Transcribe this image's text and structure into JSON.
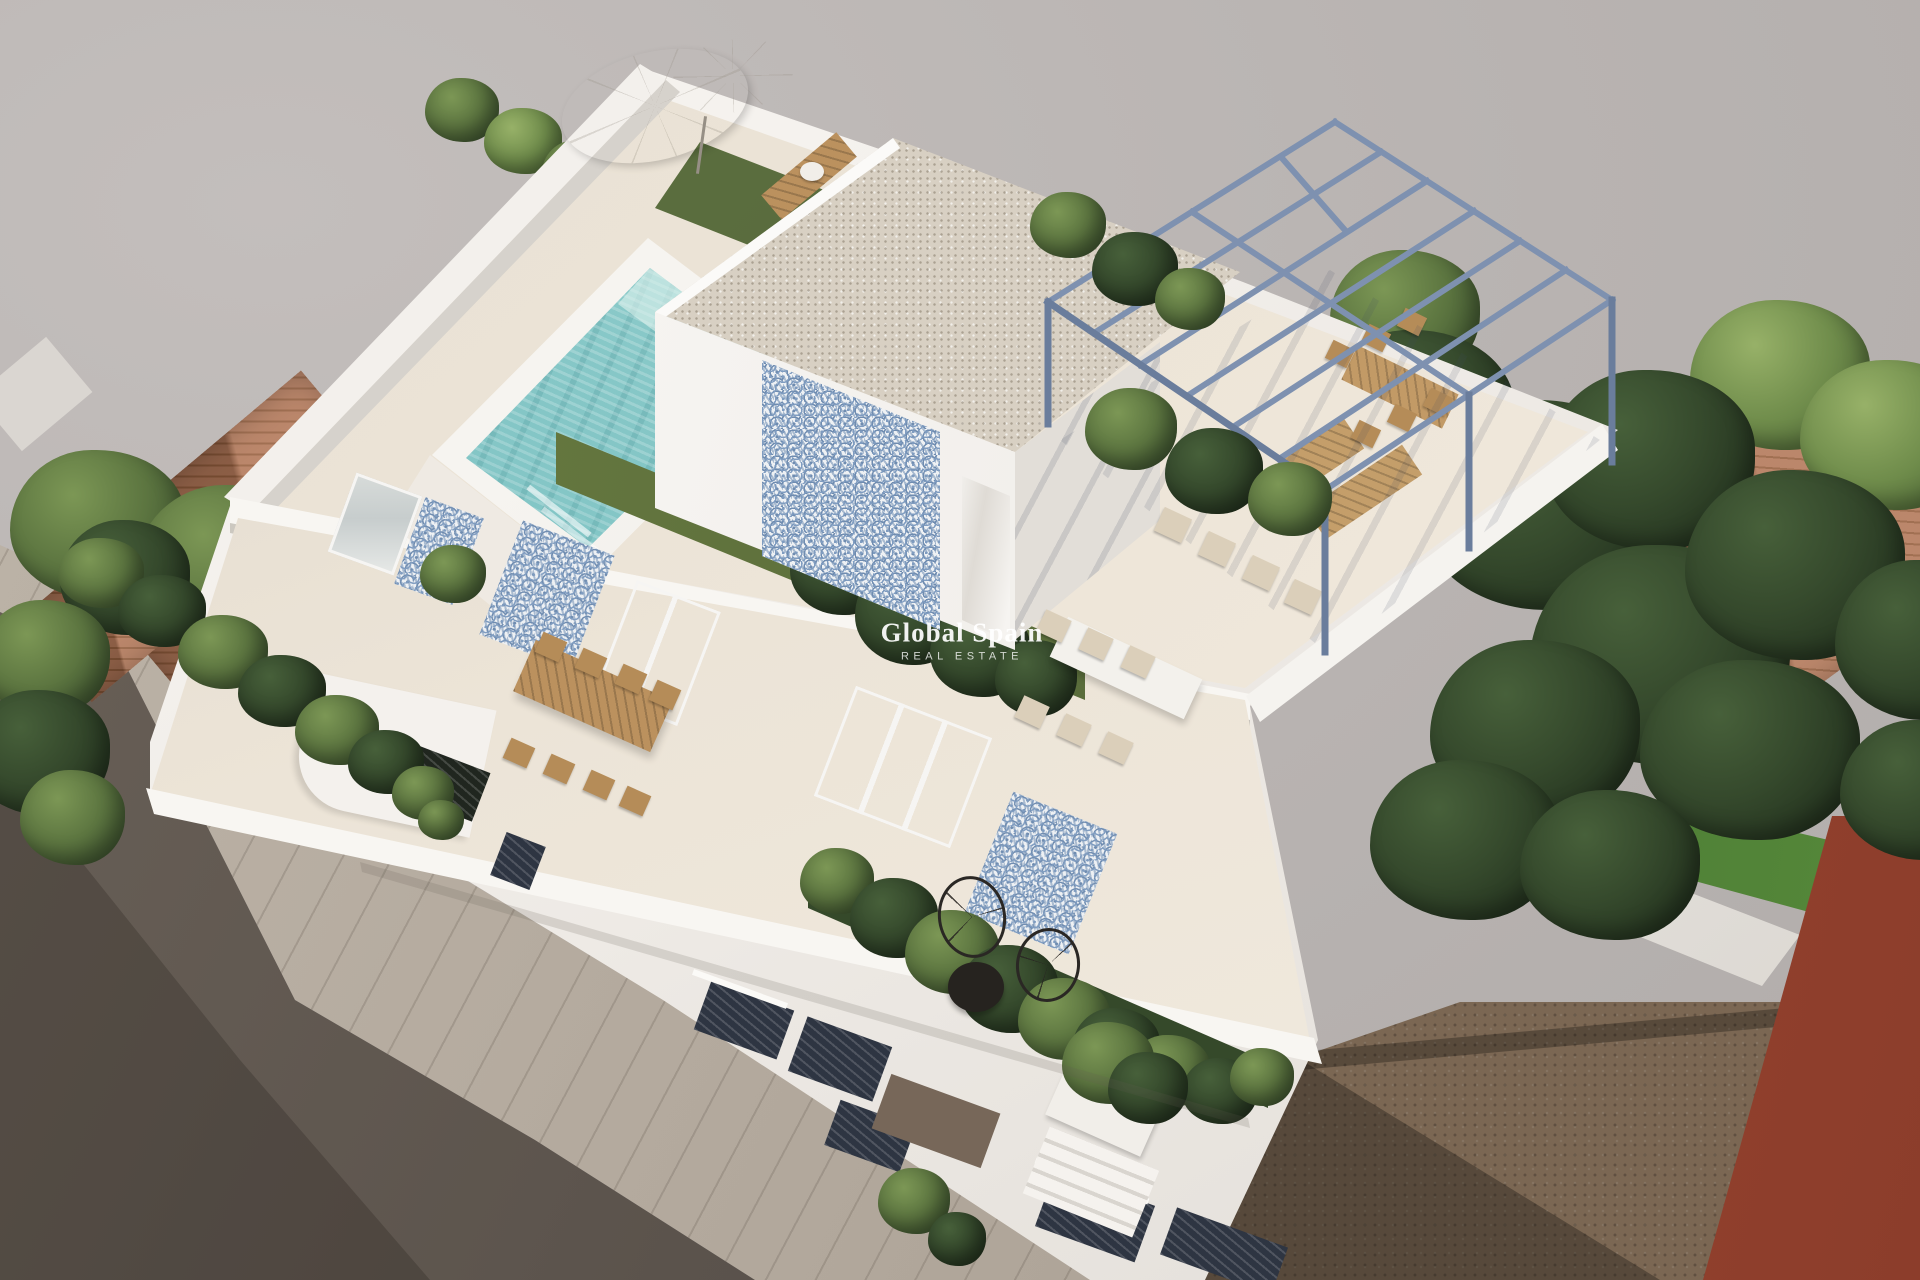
{
  "watermark": {
    "title": "Global Spain",
    "subtitle": "REAL ESTATE"
  },
  "palette": {
    "background": "#b8b3b1",
    "background_light": "#c3bebc",
    "wall_white": "#f5f2ee",
    "wall_shade": "#e2ded8",
    "terrace_floor": "#e9e1d4",
    "pool_water": "#84c6c6",
    "pool_water_light": "#b5dfda",
    "grass": "#67793f",
    "grass_dark": "#3c512c",
    "tree_light": "#7a9a55",
    "tree_mid": "#5c7540",
    "tree_dark": "#2c432a",
    "pergola_steel": "#7e91b0",
    "wood": "#bb915e",
    "terracotta": "#b3795a",
    "terracotta_dark": "#96603f",
    "asphalt": "#5b534c",
    "sidewalk": "#b4aa9e",
    "dirt": "#7b6753",
    "dirt_shadow": "#52483d",
    "red_building": "#9d4733",
    "gravel": "#d8d0c3",
    "pattern_blue": "#7f9cc0",
    "dark_window": "#2e3542",
    "black_furniture": "#26231f"
  }
}
